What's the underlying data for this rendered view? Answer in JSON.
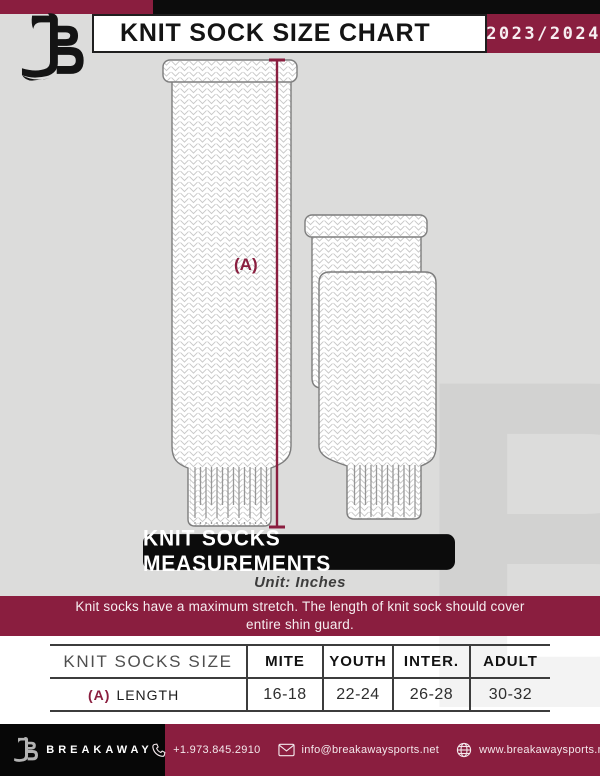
{
  "header": {
    "title": "KNIT SOCK SIZE CHART",
    "season": "2023/2024",
    "logo_name": "breakaway-b-logo"
  },
  "diagram": {
    "measurement_label": "(A)",
    "banner": "KNIT SOCKS MEASUREMENTS",
    "unit": "Unit: Inches",
    "note": "Knit socks have a maximum stretch. The length of knit sock should cover entire shin guard."
  },
  "table": {
    "columns": [
      "KNIT SOCKS SIZE",
      "MITE",
      "YOUTH",
      "INTER.",
      "ADULT"
    ],
    "row": {
      "key": "(A)",
      "label": "LENGTH",
      "values": [
        "16-18",
        "22-24",
        "26-28",
        "30-32"
      ]
    }
  },
  "footer": {
    "brand": "BREAKAWAY",
    "items": [
      {
        "icon": "phone-icon",
        "text": "+1.973.845.2910"
      },
      {
        "icon": "email-icon",
        "text": "info@breakawaysports.net"
      },
      {
        "icon": "globe-icon",
        "text": "www.breakawaysports.net"
      }
    ]
  },
  "colors": {
    "maroon": "#8a1e3f",
    "black": "#0c0c0c",
    "background_gray": "#dcdcdb",
    "sock_outline": "#7d7d7d",
    "knit_stitch": "#c7c7c7"
  },
  "watermark_letter": "B"
}
